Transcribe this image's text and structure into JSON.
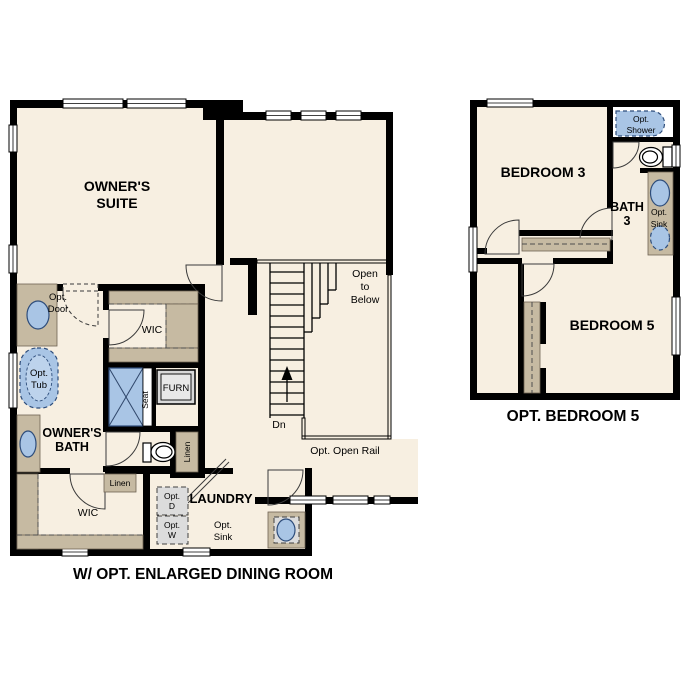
{
  "colors": {
    "background": "#ffffff",
    "wall": "#000000",
    "floor": "#f7efe1",
    "cabinet_tan": "#c6baa2",
    "fixture_blue": "#a9c5e5",
    "fixture_outline": "#2e4d7b",
    "appliance_gray": "#dcdcdc"
  },
  "left_plan": {
    "caption": "W/ OPT. ENLARGED DINING ROOM",
    "rooms": {
      "owners_suite": {
        "line1": "OWNER'S",
        "line2": "SUITE"
      },
      "owners_bath": {
        "line1": "OWNER'S",
        "line2": "BATH"
      },
      "wic_upper": "WIC",
      "wic_lower": "WIC",
      "laundry": "LAUNDRY"
    },
    "labels": {
      "opt_door": {
        "line1": "Opt.",
        "line2": "Door"
      },
      "opt_tub": {
        "line1": "Opt.",
        "line2": "Tub"
      },
      "furn": "FURN",
      "seat": "Seat",
      "linen_vertical": "Linen",
      "linen_horizontal": "Linen",
      "opt_dryer": {
        "line1": "Opt.",
        "line2": "D"
      },
      "opt_washer": {
        "line1": "Opt.",
        "line2": "W"
      },
      "opt_sink": {
        "line1": "Opt.",
        "line2": "Sink"
      },
      "open_to_below": {
        "line1": "Open",
        "line2": "to",
        "line3": "Below"
      },
      "stairs_dn": "Dn",
      "opt_open_rail": "Opt. Open Rail"
    }
  },
  "right_plan": {
    "caption": "OPT. BEDROOM 5",
    "rooms": {
      "bedroom3": "BEDROOM 3",
      "bedroom5": "BEDROOM 5",
      "bath3": {
        "line1": "BATH",
        "line2": "3"
      }
    },
    "labels": {
      "opt_shower": {
        "line1": "Opt.",
        "line2": "Shower"
      },
      "opt_sink": {
        "line1": "Opt.",
        "line2": "Sink"
      }
    }
  }
}
